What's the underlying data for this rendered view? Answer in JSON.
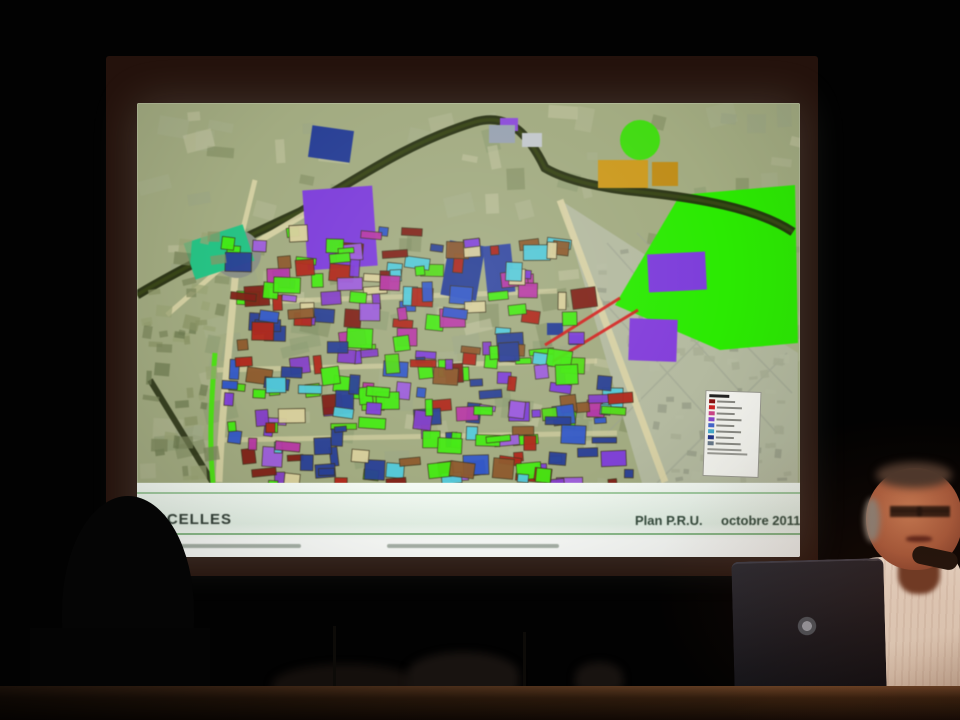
{
  "scene": {
    "type": "conference-presentation-photo",
    "room_color": "#020202",
    "table_color": "#36200f"
  },
  "screen": {
    "frame_color": "#24120c",
    "slide_bg": "#eef3e9"
  },
  "slide": {
    "title_visible": "RCELLES",
    "plan_label": "Plan P.R.U.",
    "date_label": "octobre 2011",
    "footer_band_color": "#e4f1e6",
    "footer_line_color": "#79b279",
    "title_color": "#303d35",
    "fine_print_legibility": "illegible"
  },
  "map": {
    "base_color": "#a2ab84",
    "housing_color": "#b4baa2",
    "bright_green": "#35e60f",
    "road_dark_color": "#232b10",
    "street_color": "#d9d3a8",
    "roundabout_color": "#8a9086",
    "teal_color": "#2fbf86",
    "yellow_color": "#c89a28",
    "purple_color": "#7a3fd0",
    "dark_blue_color": "#2a3f8f",
    "red_road_color": "#cc2020",
    "green_strip_color": "#55dd22",
    "seed": 20111,
    "mottle_count": 150,
    "dense_block_count": 270,
    "housing_texture_count": 90,
    "left_texture_count": 45,
    "mottle_palette": [
      "#9aa586",
      "#b3b898",
      "#8c9a74",
      "#a8b090",
      "#7d8a62",
      "#c2c4a4"
    ],
    "block_palette": [
      "#4ce61e",
      "#4ce61e",
      "#58d820",
      "#9a5fd6",
      "#7a3fd0",
      "#b03aa0",
      "#2a3f8f",
      "#3558c0",
      "#59c8d8",
      "#7a2018",
      "#a8281c",
      "#8a5a30",
      "#d8d0a0",
      "#4ce61e",
      "#8040c0",
      "#2a3f8f"
    ],
    "housing_texture_palette": [
      "#a9af97",
      "#b6bca4",
      "#9aa18c"
    ],
    "left_texture_palette": [
      "#8a9468",
      "#79855c",
      "#9aa478",
      "#6e7a52"
    ]
  },
  "legend": {
    "bg_color": "#f9f9f4",
    "title_color": "#222222",
    "row_colors": [
      "#8a1010",
      "#cc2222",
      "#cc4488",
      "#8844cc",
      "#4466cc",
      "#44aacc",
      "#223388",
      "#667788"
    ],
    "text_legibility": "illegible"
  },
  "presenter": {
    "skin_color": "#b06a4e",
    "shirt_color": "#eadfd0",
    "hair_color": "#8a8075"
  },
  "laptop": {
    "body_color": "#16161b",
    "logo": "hp"
  }
}
